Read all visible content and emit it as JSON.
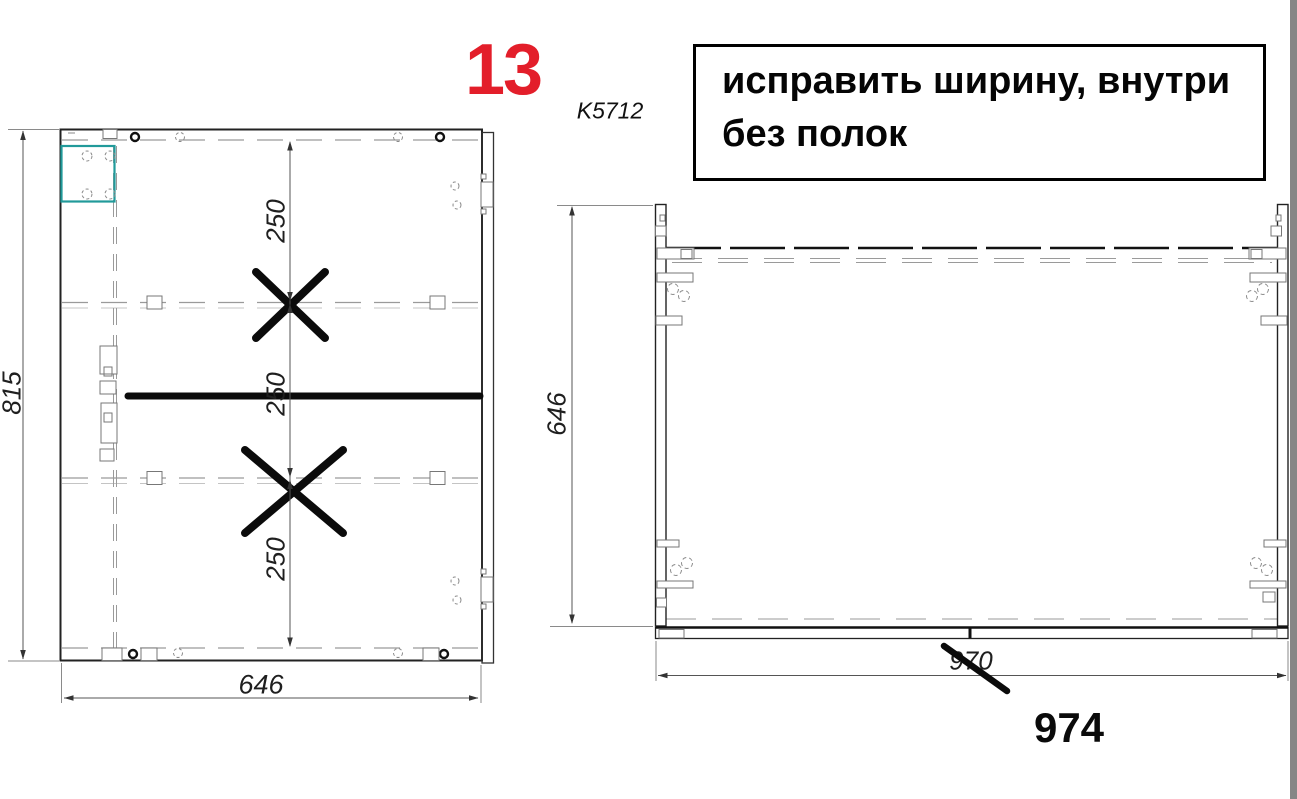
{
  "annotations": {
    "page_number": "13",
    "model_code": "K5712",
    "note_line1": "исправить ширину, внутри",
    "note_line2": "без полок"
  },
  "left_drawing": {
    "dim_height": "815",
    "dim_width": "646",
    "dim_section_1": "250",
    "dim_section_2": "250",
    "dim_section_3": "250"
  },
  "right_drawing": {
    "dim_height": "646",
    "dim_width_crossed": "970",
    "dim_width_corrected": "974"
  },
  "colors": {
    "page_number_red": "#e31e2a",
    "highlight_teal": "#219a9a",
    "window_edge_gray": "#868686"
  }
}
